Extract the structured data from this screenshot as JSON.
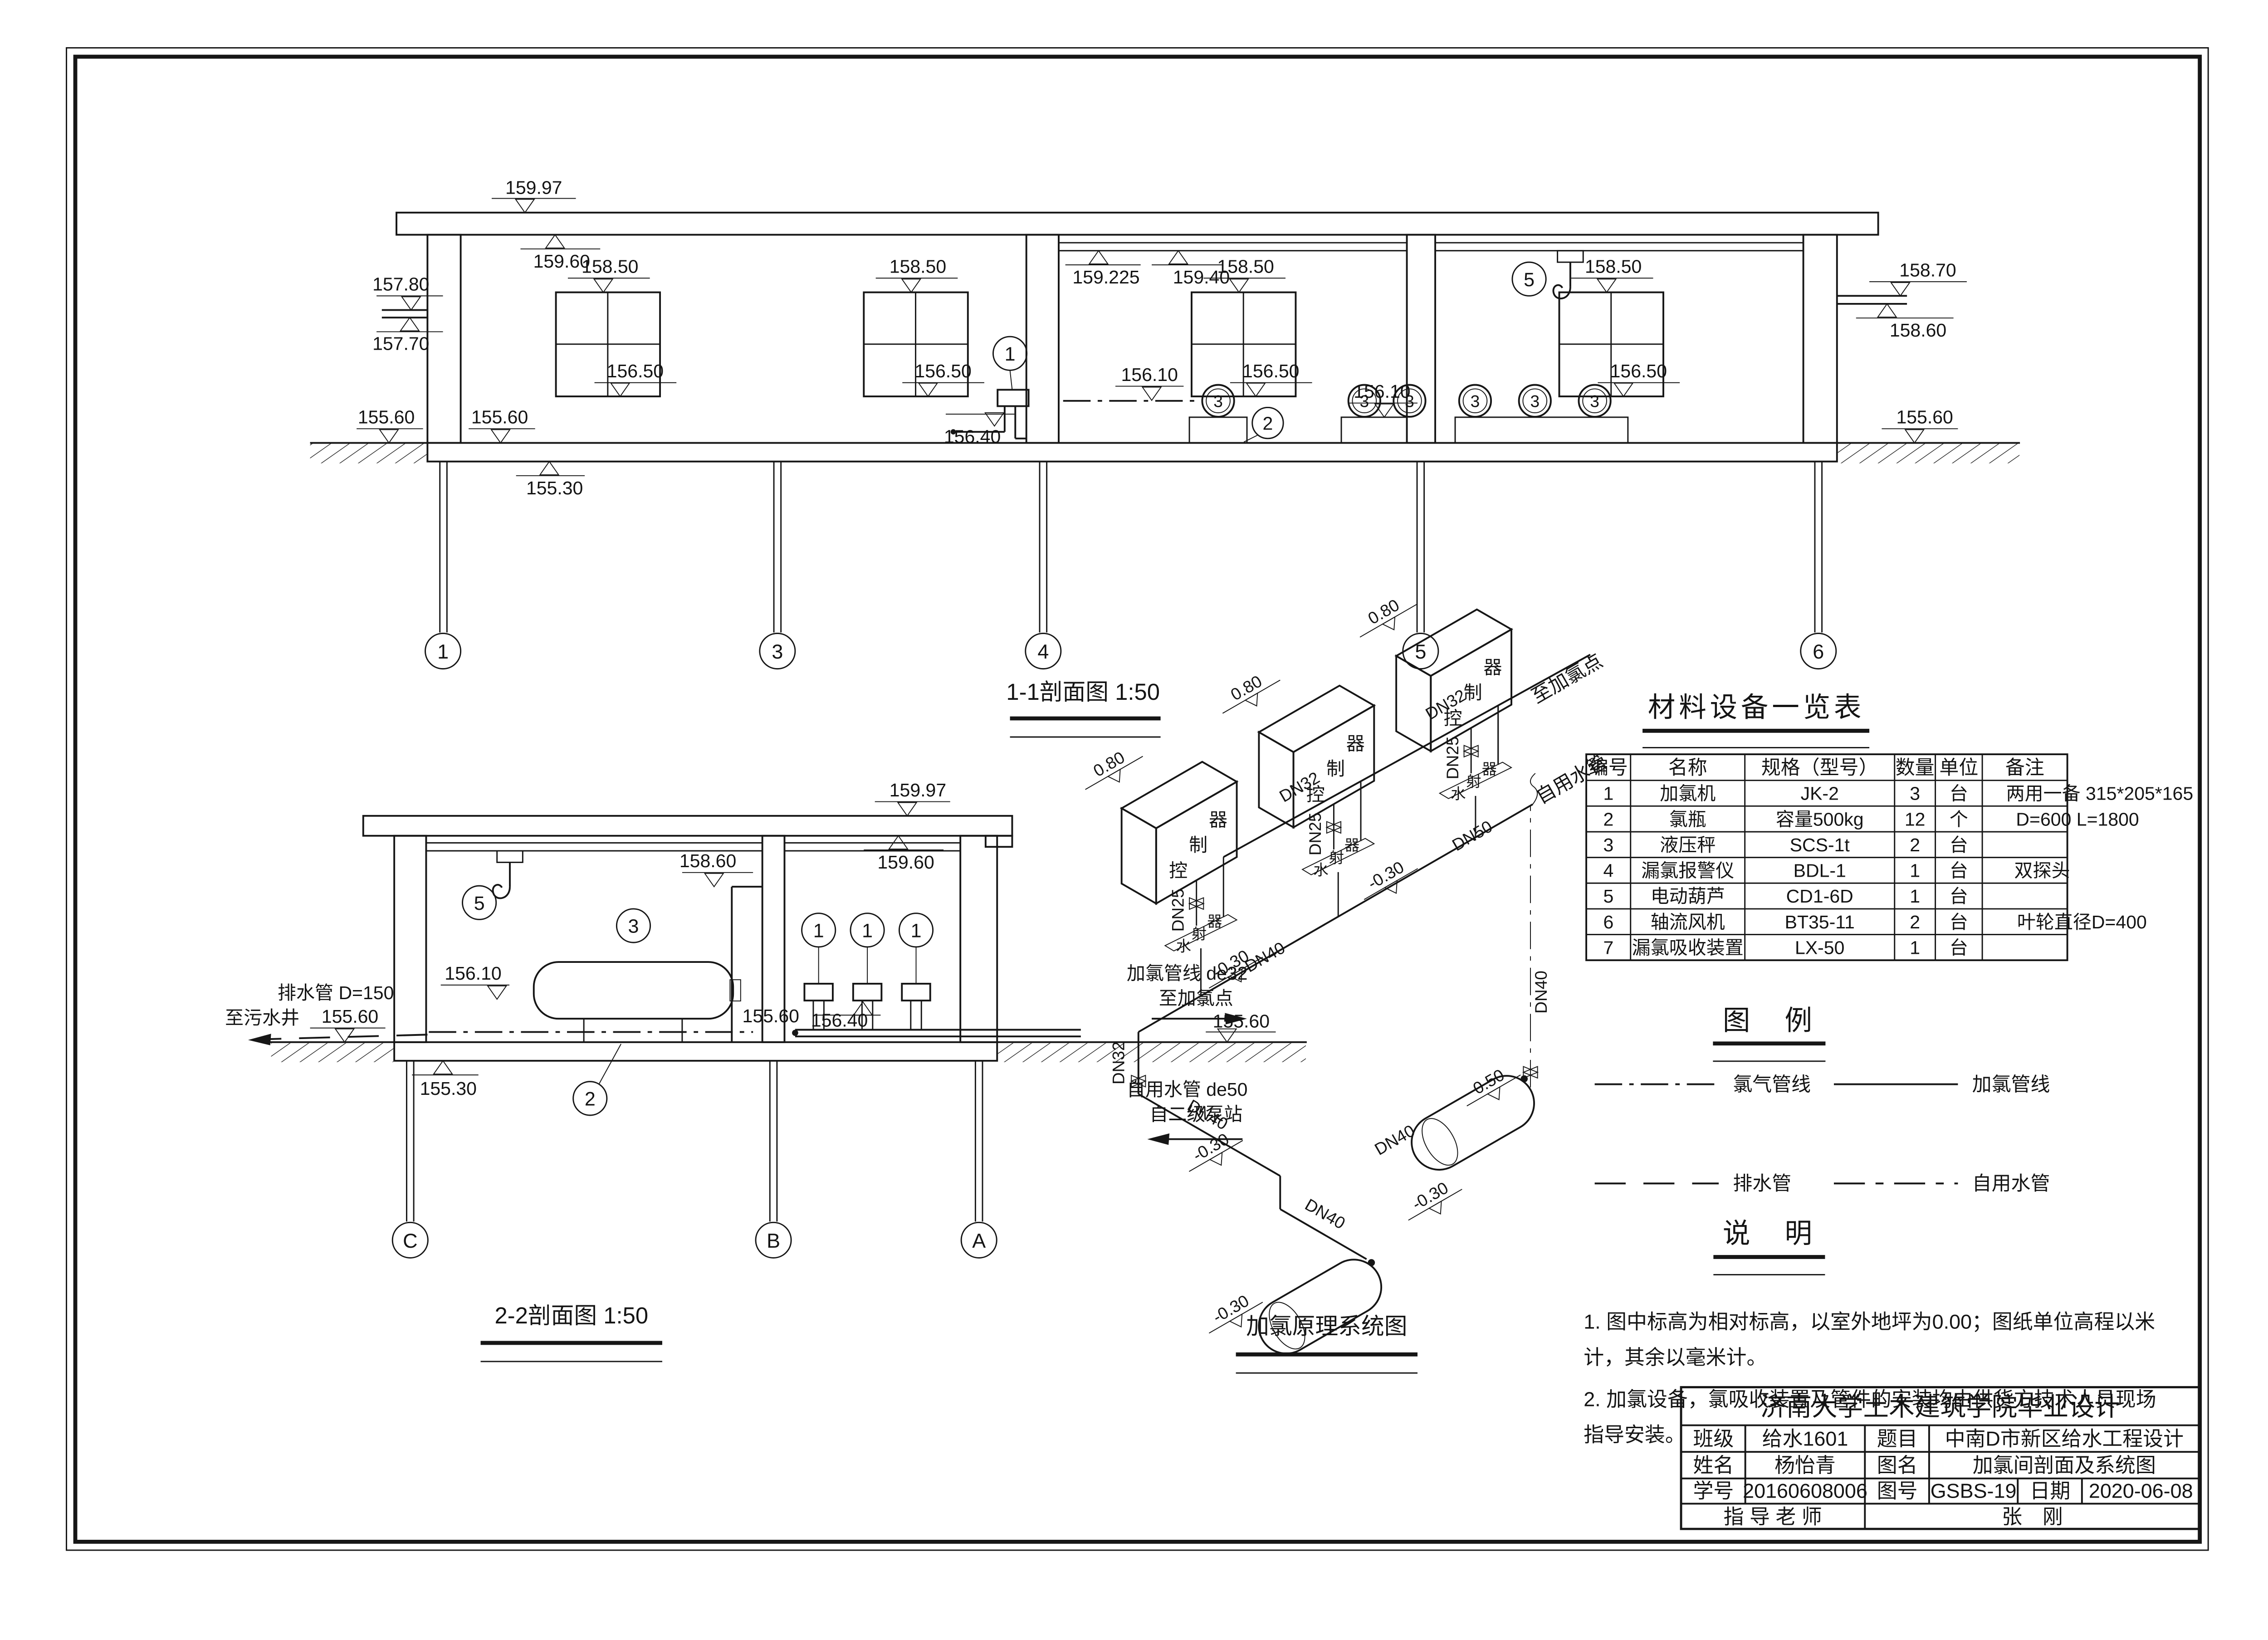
{
  "page": {
    "background": "#ffffff",
    "line_color": "#161616"
  },
  "cap": {
    "s1": "1-1剖面图  1:50",
    "s2": "2-2剖面图  1:50",
    "sys": "加氯原理系统图"
  },
  "ele": {
    "v15997": "159.97",
    "v15960": "159.60",
    "v159225": "159.225",
    "v15940": "159.40",
    "v15870": "158.70",
    "v15860": "158.60",
    "v15850": "158.50",
    "v15780": "157.80",
    "v15770": "157.70",
    "v15650": "156.50",
    "v15640": "156.40",
    "v15610": "156.10",
    "v15560": "155.60",
    "v15530": "155.30"
  },
  "tags": {
    "t1": "1",
    "t2": "2",
    "t3": "3",
    "t5": "5"
  },
  "grid": {
    "g1": "1",
    "g3": "3",
    "g4": "4",
    "g5": "5",
    "g6": "6",
    "gc": "C",
    "gb": "B",
    "ga": "A"
  },
  "ann": {
    "drainPipe": "排水管 D=150",
    "toSewage": "至污水井",
    "chlorLine": "加氯管线 de32",
    "toChlorPoint": "至加氯点",
    "selfWaterPipe": "自用水管 de50",
    "fromPump": "自二级泵站"
  },
  "sys": {
    "e080": "0.80",
    "em030": "-0.30",
    "e050": "0.50",
    "dn25": "DN25",
    "dn32": "DN32",
    "dn40": "DN40",
    "dn50": "DN50",
    "selfWater": "自用水管",
    "ctrl": [
      "器",
      "制",
      "控"
    ],
    "jet": [
      "器",
      "射",
      "水"
    ]
  },
  "tbl": {
    "title": "材料设备一览表",
    "h": [
      "编号",
      "名称",
      "规格（型号）",
      "数量",
      "单位",
      "备注"
    ],
    "r": [
      [
        "1",
        "加氯机",
        "JK-2",
        "3",
        "台",
        "两用一备 315*205*165"
      ],
      [
        "2",
        "氯瓶",
        "容量500kg",
        "12",
        "个",
        "D=600  L=1800"
      ],
      [
        "3",
        "液压秤",
        "SCS-1t",
        "2",
        "台",
        ""
      ],
      [
        "4",
        "漏氯报警仪",
        "BDL-1",
        "1",
        "台",
        "双探头"
      ],
      [
        "5",
        "电动葫芦",
        "CD1-6D",
        "1",
        "台",
        ""
      ],
      [
        "6",
        "轴流风机",
        "BT35-11",
        "2",
        "台",
        "叶轮直径D=400"
      ],
      [
        "7",
        "漏氯吸收装置",
        "LX-50",
        "1",
        "台",
        ""
      ]
    ]
  },
  "leg": {
    "title": "图　例",
    "i0": "氯气管线",
    "i1": "加氯管线",
    "i2": "排水管",
    "i3": "自用水管"
  },
  "notes": {
    "title": "说　明",
    "l0": "1. 图中标高为相对标高，以室外地坪为0.00；图纸单位高程以米",
    "l1": "计，其余以毫米计。",
    "l2": "2. 加氯设备，氯吸收装置及管件的安装均由供货方技术人员现场",
    "l3": "指导安装。"
  },
  "tb": {
    "school": "济南大学土木建筑学院毕业设计",
    "clsL": "班级",
    "cls": "给水1601",
    "subL": "题目",
    "sub": "中南D市新区给水工程设计",
    "nameL": "姓名",
    "name": "杨怡青",
    "dwgL": "图名",
    "dwg": "加氯间剖面及系统图",
    "sidL": "学号",
    "sid": "20160608006",
    "noL": "图号",
    "no": "GSBS-19",
    "dateL": "日期",
    "date": "2020-06-08",
    "advL": "指 导 老 师",
    "adv": "张　刚"
  }
}
